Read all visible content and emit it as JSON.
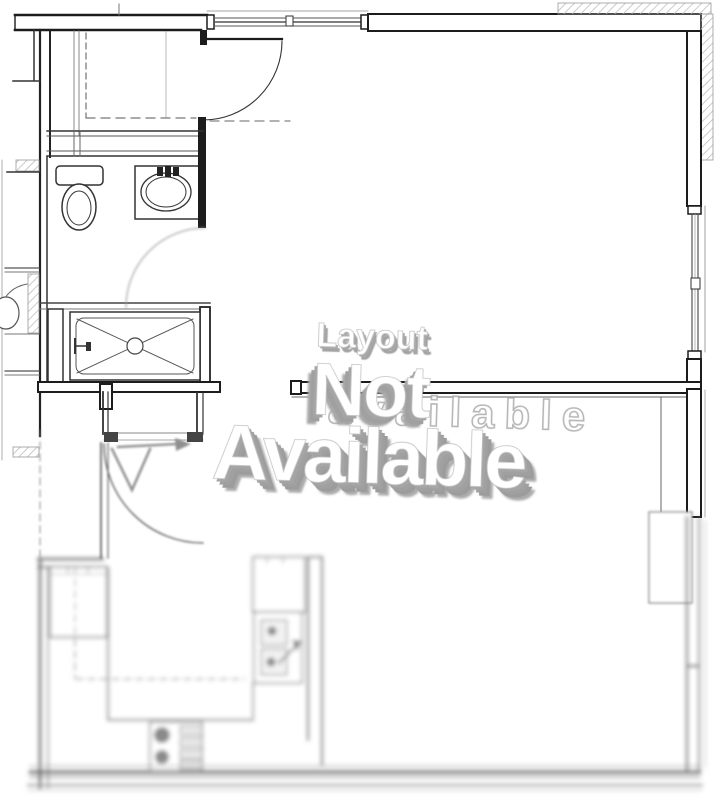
{
  "watermark": {
    "line1": "Layout",
    "line2": "Not",
    "line3": "Available",
    "ghost": "available",
    "text_color": "#ffffff",
    "shadow_color": "#a0a0a0"
  },
  "plan": {
    "fixture_icons": [
      "toilet-icon",
      "vanity-sink-icon",
      "shower-tray-icon",
      "entry-arrow-icon",
      "door-swing-icon",
      "refrigerator-icon",
      "range-icon",
      "kitchen-sink-icon",
      "window-icon",
      "hatched-wall-icon"
    ]
  },
  "colors": {
    "background": "#ffffff",
    "wall_line": "#1c1c1c",
    "medium_line": "#555555",
    "light_line": "#888888",
    "blurred_line": "#7a7a7a",
    "hatch": "#bdbdbd"
  }
}
